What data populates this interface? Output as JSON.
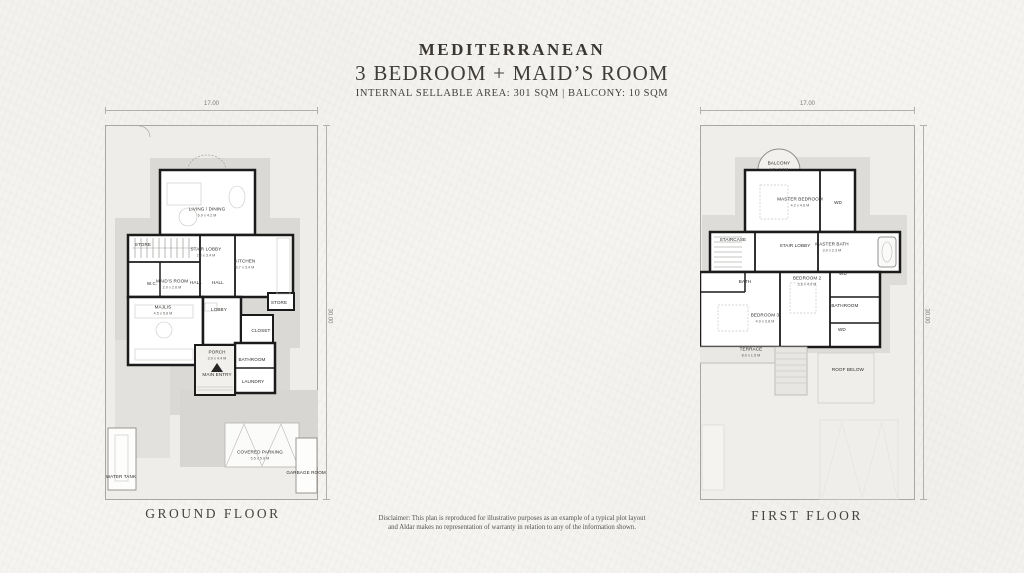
{
  "header": {
    "title": "MEDITERRANEAN",
    "subtitle": "3 BEDROOM + MAID’S ROOM",
    "area_line": "INTERNAL SELLABLE AREA:  301 SQM | BALCONY: 10 SQM"
  },
  "disclaimer": {
    "line1": "Disclaimer: This plan is reproduced for illustrative purposes as an example of a typical plot layout",
    "line2": "and Aldar makes no representation of warranty in relation to any of the information shown."
  },
  "ground_floor": {
    "caption": "GROUND FLOOR",
    "width_dim": "17.00",
    "height_dim": "30.00",
    "rooms": [
      {
        "label": "LIVING / DINING",
        "dims": "6.9 x 4.2 M",
        "x": 47.9,
        "y": 23.2
      },
      {
        "label": "STORE",
        "x": 17.8,
        "y": 32.0
      },
      {
        "label": "STAIR LOBBY",
        "dims": "2.8 x 3.4 M",
        "x": 47.4,
        "y": 33.9
      },
      {
        "label": "KITCHEN",
        "dims": "3.7 x 3.4 M",
        "x": 65.7,
        "y": 37.1
      },
      {
        "label": "W.C.",
        "x": 22.1,
        "y": 42.4
      },
      {
        "label": "MAID’S ROOM",
        "dims": "2.0 x 2.6 M",
        "x": 31.5,
        "y": 42.4
      },
      {
        "label": "HALL",
        "x": 42.7,
        "y": 42.1
      },
      {
        "label": "HALL",
        "x": 53.0,
        "y": 42.1
      },
      {
        "label": "MAJLIS",
        "dims": "4.5 x 5.6 M",
        "x": 27.2,
        "y": 49.3
      },
      {
        "label": "LOBBY",
        "x": 53.5,
        "y": 49.3
      },
      {
        "label": "STORE",
        "x": 81.7,
        "y": 47.5
      },
      {
        "label": "CLOSET",
        "x": 73.2,
        "y": 54.9
      },
      {
        "label": "PORCH",
        "dims": "3.0 x 4.4 M",
        "x": 52.6,
        "y": 61.3
      },
      {
        "label": "MAIN ENTRY",
        "x": 52.6,
        "y": 66.6
      },
      {
        "label": "BATHROOM",
        "x": 69.0,
        "y": 62.7
      },
      {
        "label": "LAUNDRY",
        "x": 69.5,
        "y": 68.5
      },
      {
        "label": "WATER TANK",
        "x": 7.5,
        "y": 93.9
      },
      {
        "label": "COVERED PARKING",
        "dims": "5.5 x 5.0 M",
        "x": 72.8,
        "y": 88.0
      },
      {
        "label": "GARBAGE ROOM",
        "x": 94.4,
        "y": 92.8
      }
    ]
  },
  "first_floor": {
    "caption": "FIRST FLOOR",
    "width_dim": "17.00",
    "height_dim": "30.00",
    "rooms": [
      {
        "label": "BALCONY",
        "dims": "4.2 x 1.9 M",
        "x": 36.7,
        "y": 10.9
      },
      {
        "label": "MASTER BEDROOM",
        "dims": "4.2 x 4.6 M",
        "x": 46.5,
        "y": 20.5
      },
      {
        "label": "WD",
        "x": 64.2,
        "y": 20.8
      },
      {
        "label": "STAIRCASE",
        "x": 15.3,
        "y": 30.7
      },
      {
        "label": "STAIR LOBBY",
        "x": 44.2,
        "y": 32.3
      },
      {
        "label": "MASTER BATH",
        "dims": "3.0 x 2.3 M",
        "x": 61.4,
        "y": 32.5
      },
      {
        "label": "BATH",
        "x": 20.9,
        "y": 41.9
      },
      {
        "label": "BEDROOM 2",
        "dims": "3.6 x 4.0 M",
        "x": 49.8,
        "y": 41.6
      },
      {
        "label": "WD",
        "x": 66.5,
        "y": 39.7
      },
      {
        "label": "BATHROOM",
        "x": 67.4,
        "y": 48.3
      },
      {
        "label": "WD",
        "x": 66.0,
        "y": 54.7
      },
      {
        "label": "BEDROOM 3",
        "dims": "4.0 x 3.8 M",
        "x": 30.2,
        "y": 51.5
      },
      {
        "label": "TERRACE",
        "dims": "8.0 x 1.5 M",
        "x": 23.7,
        "y": 60.5
      },
      {
        "label": "ROOF BELOW",
        "x": 68.8,
        "y": 65.3
      }
    ]
  }
}
